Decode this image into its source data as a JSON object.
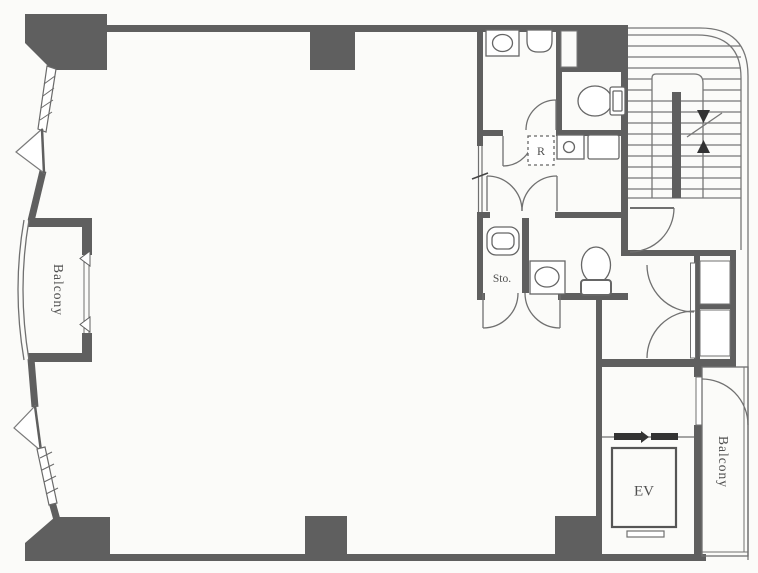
{
  "title": "apartment-floor-plan",
  "labels": {
    "balcony_left": "Balcony",
    "balcony_right": "Balcony",
    "elevator": "EV",
    "storage": "Sto.",
    "refrigerator": "R"
  },
  "fixtures": [
    "washing-machine",
    "wash-basin",
    "toilet-upper",
    "kitchen-sink",
    "kitchen-counter",
    "refrigerator-box",
    "bathtub",
    "vanity-sink",
    "toilet-lower",
    "staircase",
    "elevator-cab",
    "entrance-double-door",
    "balcony-sliding-windows",
    "casement-windows"
  ],
  "colors": {
    "wall": "#5f5f5f",
    "line": "#707070",
    "background": "#fbfbf9",
    "text": "#4f4f4f"
  }
}
